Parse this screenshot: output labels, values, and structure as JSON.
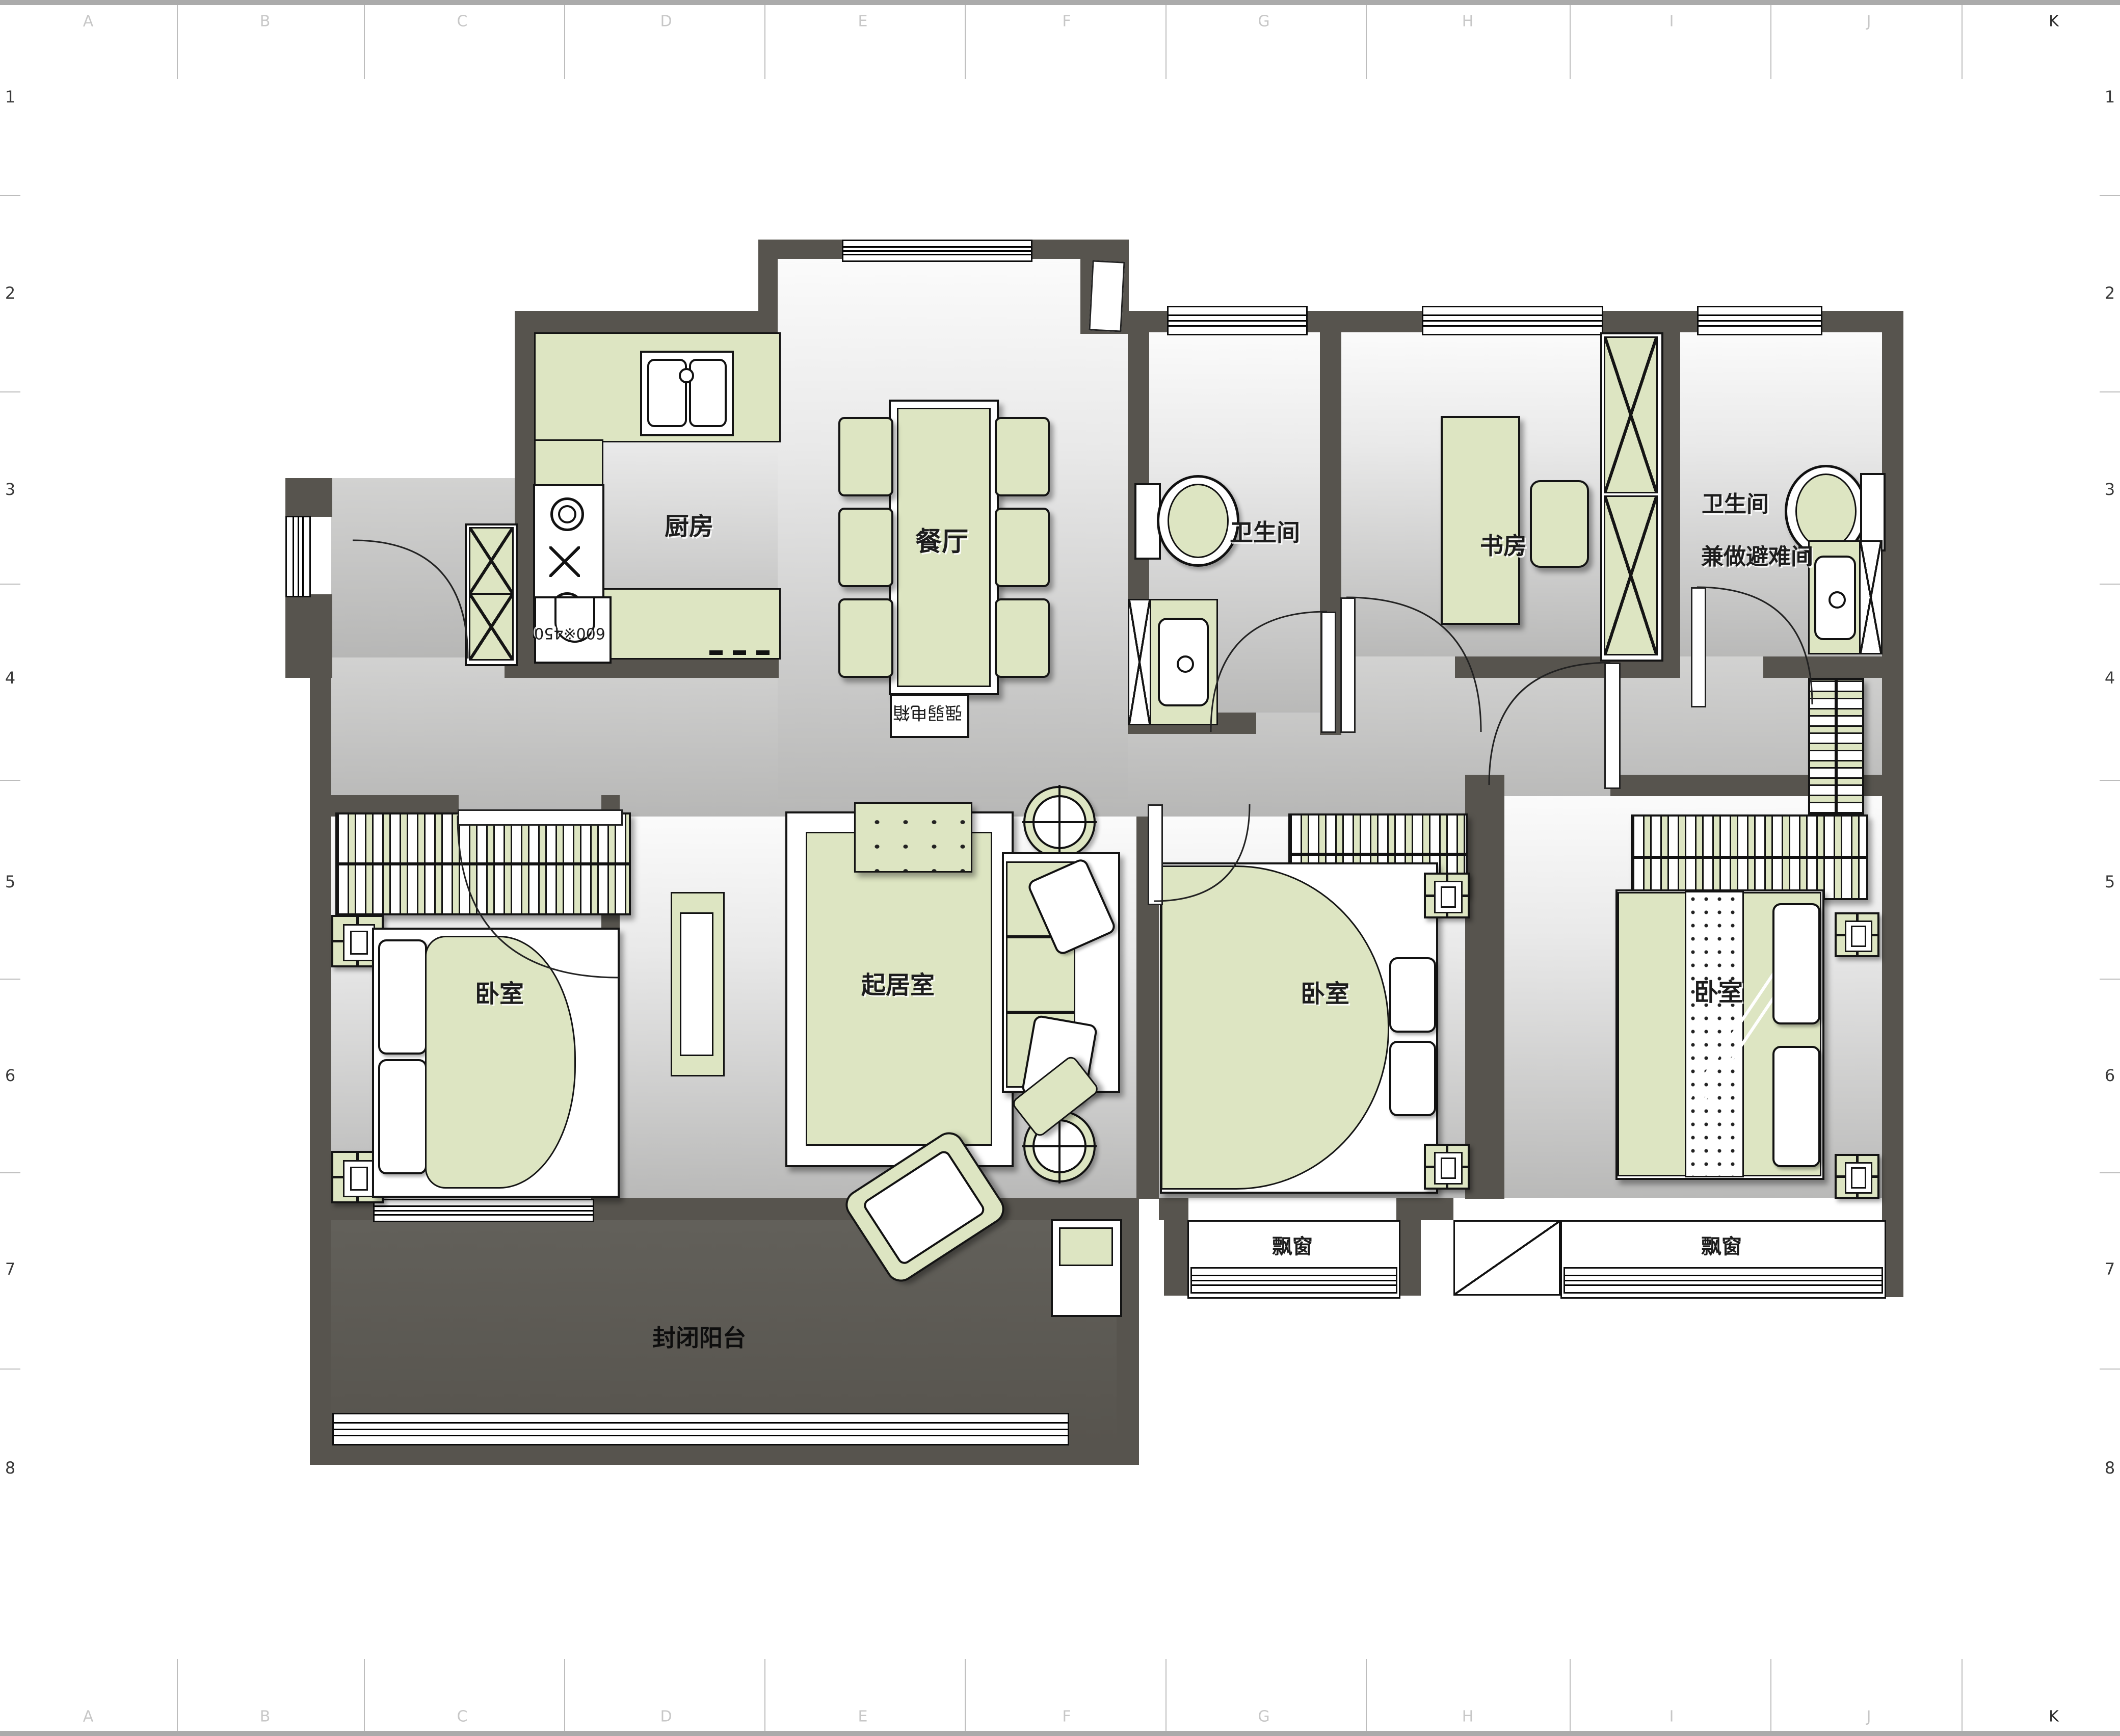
{
  "grid": {
    "letters": [
      "A",
      "B",
      "C",
      "D",
      "E",
      "F",
      "G",
      "H",
      "I",
      "J",
      "K"
    ],
    "numbers": [
      "1",
      "2",
      "3",
      "4",
      "5",
      "6",
      "7",
      "8"
    ]
  },
  "rooms": {
    "kitchen": "厨房",
    "dining": "餐厅",
    "bath1": "卫生间",
    "study": "书房",
    "bath2_line1": "卫生间",
    "bath2_line2": "兼做避难间",
    "bedroom_left": "卧室",
    "living": "起居室",
    "bedroom_mid": "卧室",
    "bedroom_master": "卧室",
    "bay_mid": "飘窗",
    "bay_right": "飘窗",
    "balcony": "封闭阳台"
  },
  "annotations": {
    "utility_box": "强弱电箱",
    "kitchen_unit": "600※450"
  },
  "colors": {
    "wall": "#57544e",
    "furniture": "#dde5c2",
    "balcony_floor": "#5c5952"
  }
}
